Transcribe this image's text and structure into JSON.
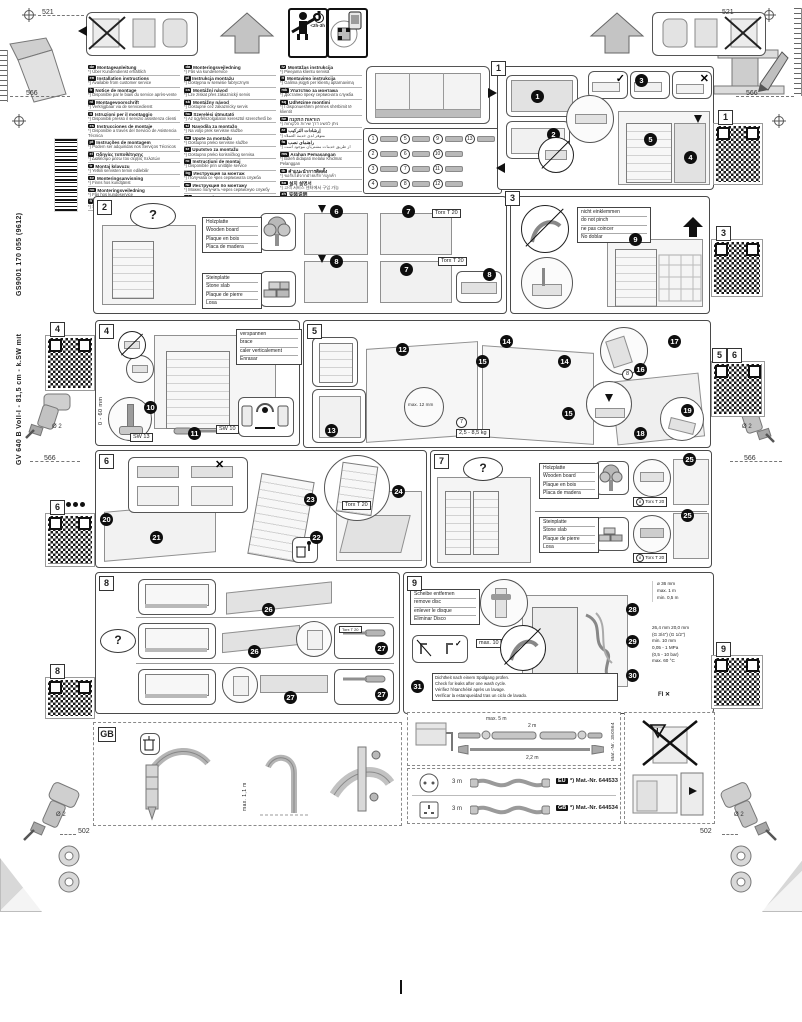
{
  "doc": {
    "dim_521": "521",
    "dim_566": "566",
    "dim_502": "502",
    "drill_dia": "Ø 2",
    "time_estimate": "<2h-3h",
    "vertical_code": "GS9001 170 055 (9612)",
    "vertical_model": "GV 640 B Voll-I - 81,5 cm - k.SW mit"
  },
  "common": {
    "torx": "Torx T 20",
    "question": "?",
    "check": "✓",
    "cross": "✕",
    "warning": "!"
  },
  "languages": {
    "col1": [
      {
        "code": "de",
        "title": "Montageanleitung",
        "note": "*) Über Kundendienst erhältlich"
      },
      {
        "code": "en",
        "title": "Installation instructions",
        "note": "*) Available from customer service"
      },
      {
        "code": "fr",
        "title": "Notice de montage",
        "note": "*) Disponible par le biais du service après-vente"
      },
      {
        "code": "nl",
        "title": "Montagevoorschrift",
        "note": "*) Verkrijgbaar via de servicedienst"
      },
      {
        "code": "it",
        "title": "Istruzioni per il montaggio",
        "note": "*) Disponibili presso il servizio assistenza clienti"
      },
      {
        "code": "es",
        "title": "Instrucciones de montaje",
        "note": "*) Disponible a través del Servicio de Asistencia Técnica"
      },
      {
        "code": "pt",
        "title": "Instruções de montagem",
        "note": "*) Podem ser adquiridas nos Serviços Técnicos"
      },
      {
        "code": "el",
        "title": "Οδηγίες τοποθέτησης",
        "note": "*) Διαθέσιμο μέσω του σέρβις πελατών"
      },
      {
        "code": "tr",
        "title": "Montaj kılavuzu",
        "note": "*) Yetkili servisten temin edilebilir"
      },
      {
        "code": "sv",
        "title": "Monteringsanvisning",
        "note": "*) Finns hos kundtjänst"
      },
      {
        "code": "no",
        "title": "Monteringsveiledning",
        "note": "*) Fås hos kundeservice"
      },
      {
        "code": "fi",
        "title": "Asennusohje",
        "note": "*) Saatavana huoltopalvelusta"
      }
    ],
    "col2": [
      {
        "code": "da",
        "title": "Monteringsvejledning",
        "note": "*) Fås via kundeservice"
      },
      {
        "code": "pl",
        "title": "Instrukcja montażu",
        "note": "*) Dostępna w serwisie fabrycznym"
      },
      {
        "code": "cs",
        "title": "Montážní návod",
        "note": "*) Lze získat přes zákaznický servis"
      },
      {
        "code": "sk",
        "title": "Montážny návod",
        "note": "*) Dostupné cez zákaznícky servis"
      },
      {
        "code": "hu",
        "title": "Szerelési útmutató",
        "note": "*) Az ügyfélszolgálaton keresztül szerezhető be"
      },
      {
        "code": "sl",
        "title": "Navodila za montažo",
        "note": "*) Na voljo prek servisne službe"
      },
      {
        "code": "hr",
        "title": "Upute za montažu",
        "note": "*) Dostupno preko servisne službe"
      },
      {
        "code": "sr",
        "title": "Uputstvo za montažu",
        "note": "*) Dostupno preko korisničkog servisa"
      },
      {
        "code": "ro",
        "title": "Instrucţiuni de montaj",
        "note": "*) Disponibile prin unităţile service"
      },
      {
        "code": "bg",
        "title": "Инструкция за монтаж",
        "note": "*) Получава се чрез сервизната служба"
      },
      {
        "code": "ru",
        "title": "Инструкция по монтажу",
        "note": "*) Можно получить через сервисную службу"
      },
      {
        "code": "uk",
        "title": "Інструкція з монтажу",
        "note": "*) Можна отримати через сервісну службу"
      },
      {
        "code": "et",
        "title": "Paigaldusjuhend",
        "note": "*) Saadaval klienditeeninduse kaudu"
      }
    ],
    "col3": [
      {
        "code": "lv",
        "title": "Montāžas instrukcija",
        "note": "*) Pieejama klientu servisā"
      },
      {
        "code": "lt",
        "title": "Montavimo instrukcija",
        "note": "*) Galima įsigyti per klientų aptarnavimą"
      },
      {
        "code": "mk",
        "title": "Упатство за монтажа",
        "note": "*) Достапно преку сервисната служба"
      },
      {
        "code": "sq",
        "title": "Udhëzime montimi",
        "note": "*) I disponueshëm përmes shërbimit të klientit"
      },
      {
        "code": "he",
        "title": "הוראות התקנה",
        "note": "*) ניתן להשיג דרך שירות הלקוחות"
      },
      {
        "code": "ar",
        "title": "إرشادات التركيب",
        "note": "*) متوفر لدى خدمة العملاء"
      },
      {
        "code": "fa",
        "title": "راهنمای نصب",
        "note": "*) از طریق خدمات مشتریان موجود است"
      },
      {
        "code": "ms",
        "title": "Arahan Pemasangan",
        "note": "*) Boleh didapati melalui Khidmat Pelanggan"
      },
      {
        "code": "th",
        "title": "คำแนะนำการติดตั้ง",
        "note": "*) ขอรับได้จากฝ่ายบริการลูกค้า"
      },
      {
        "code": "ko",
        "title": "설치 설명서",
        "note": "*) 고객 서비스 센터에서 구입 가능"
      },
      {
        "code": "zh",
        "title": "安装说明",
        "note": "*) 可向客户服务部购买"
      },
      {
        "code": "zh",
        "title": "安裝說明",
        "note": "*) 可向客戶服務部購買"
      }
    ]
  },
  "parts": {
    "items": [
      {
        "num": "1"
      },
      {
        "num": "2"
      },
      {
        "num": "3"
      },
      {
        "num": "4"
      },
      {
        "num": "5"
      },
      {
        "num": "6"
      },
      {
        "num": "7"
      },
      {
        "num": "8"
      },
      {
        "num": "9"
      },
      {
        "num": "10"
      },
      {
        "num": "11"
      },
      {
        "num": "12"
      },
      {
        "num": "13"
      }
    ]
  },
  "panels": {
    "p1": {
      "label": "1",
      "steps": [
        "1",
        "2",
        "3",
        "4",
        "5"
      ]
    },
    "p2": {
      "label": "2",
      "steps": [
        "6",
        "7",
        "8"
      ],
      "wood": [
        "Holzplatte",
        "Wooden board",
        "Plaque en bois",
        "Placa de madera"
      ],
      "stone": [
        "Steinplatte",
        "Stone slab",
        "Plaque de pierre",
        "Losa"
      ]
    },
    "p3": {
      "label": "3",
      "step": "9",
      "pinch": [
        "nicht einklemmen",
        "do not pinch",
        "ne pas coincer",
        "No doblar"
      ]
    },
    "p4": {
      "label": "4",
      "steps": [
        "10",
        "11"
      ],
      "brace": [
        "verspannen",
        "brace",
        "caler verticalement",
        "Enrasar"
      ],
      "range": "0 - 60 mm",
      "sw13": "SW 13",
      "sw10": "SW 10"
    },
    "p5": {
      "label": "5",
      "steps": [
        "12",
        "13",
        "14",
        "15",
        "16",
        "17",
        "18",
        "19"
      ],
      "gap": "max. 12 mm",
      "weight": "2,5 - 8,5 kg",
      "part_ref_a": "7",
      "part_ref_b": "8"
    },
    "p6": {
      "label": "6",
      "steps": [
        "20",
        "21",
        "22",
        "23",
        "24"
      ]
    },
    "p7": {
      "label": "7",
      "step": "25",
      "part_ref": "8",
      "wood": [
        "Holzplatte",
        "Wooden board",
        "Plaque en bois",
        "Placa de madera"
      ],
      "stone": [
        "Steinplatte",
        "Stone slab",
        "Plaque de pierre",
        "Losa"
      ]
    },
    "p8": {
      "label": "8",
      "steps": [
        "26",
        "27"
      ]
    },
    "p9": {
      "label": "9",
      "steps": [
        "28",
        "29",
        "30",
        "31"
      ],
      "disc": [
        "Scheibe entfernen",
        "remove disc",
        "enlever le disque",
        "Eliminar Disco"
      ],
      "torque": "max. 10 Nm",
      "leak_check": [
        "Dichtheit nach einem Spülgang prüfen.",
        "Check for leaks after one wash cycle.",
        "Vérifiez l'étanchéité après un lavage.",
        "Verificar la estanqueidad tras un ciclo de lavado."
      ],
      "dims": {
        "hose_dia": "ø 36 mm",
        "height_max": "max. 1 m",
        "height_min": "min. 0,5 m",
        "nut_a": "26,4 mm",
        "nut_b": "20,0 mm",
        "thread_a": "(G 3/4\")",
        "thread_b": "(G 1/2\")",
        "clearance": "min. 10 mm",
        "pressure": "0,05 - 1 MPa",
        "pressure_bar": "(0,5 - 10 bar)",
        "temp": "max. 60 °C",
        "rcd": "FI"
      }
    },
    "gb": {
      "label": "GB",
      "height": "max. 1,1 m"
    }
  },
  "bottom": {
    "hose": {
      "total": "max. 5 m",
      "len1": "2 m",
      "len2": "2,2 m",
      "mat": "Mat.-Nr. 350564"
    },
    "cord1": {
      "length": "3 m",
      "region": "EU",
      "mat": "*) Mat.-Nr. 644533"
    },
    "cord2": {
      "length": "3 m",
      "region": "GB",
      "mat": "*) Mat.-Nr. 644534"
    }
  },
  "margins": {
    "qr1": "1",
    "qr3": "3",
    "qr4": "4",
    "qr5": "5",
    "qr6": "6",
    "qr8": "8",
    "qr9": "9"
  }
}
